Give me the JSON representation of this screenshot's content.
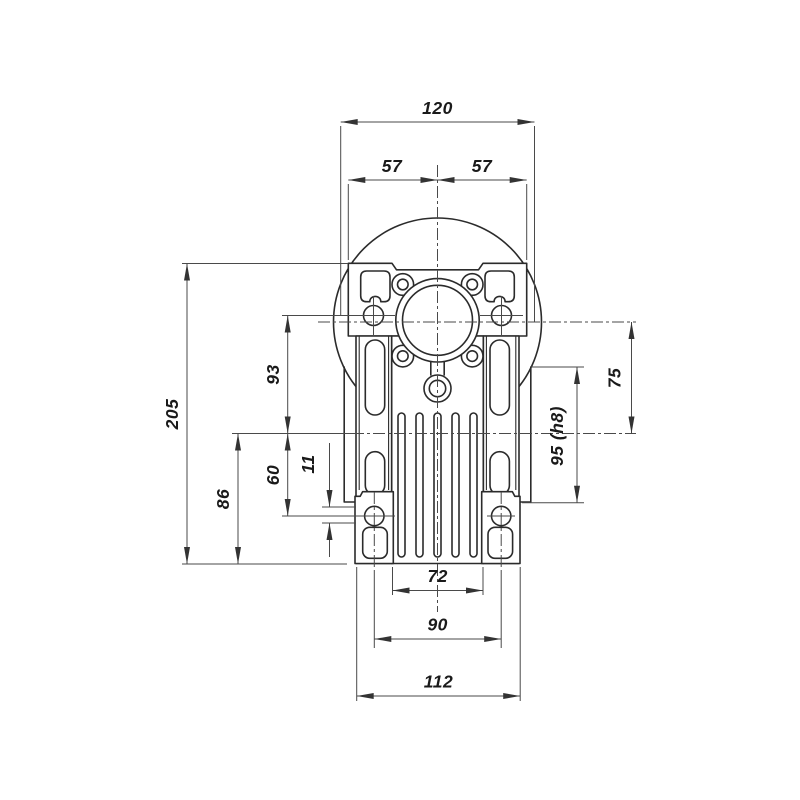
{
  "drawing": {
    "type": "technical-dimension-drawing",
    "subject": "worm gearbox front view with dimensions",
    "colors": {
      "background": "#ffffff",
      "object_line": "#2b2b2b",
      "dimension_line": "#4a4a4a",
      "text": "#1a1a1a"
    },
    "dimensions": {
      "flange_width_overall": "120",
      "flange_half_left": "57",
      "flange_half_right": "57",
      "height_overall": "205",
      "flange_hole_to_output_axis": "93",
      "output_axis_to_base": "86",
      "output_axis_to_foot_hole": "60",
      "foot_hole_offset": "11",
      "input_axis_to_output_axis": "75",
      "output_boss_diameter": "95 (h8)",
      "fin_body_width": "72",
      "foot_hole_spacing": "90",
      "foot_width_overall": "112"
    }
  }
}
